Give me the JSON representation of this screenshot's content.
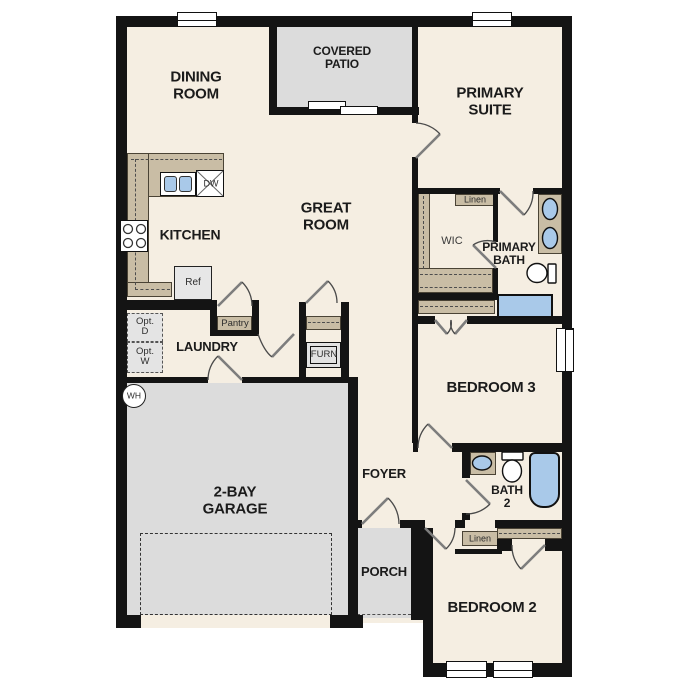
{
  "title": "Single-story floor plan",
  "colors": {
    "interior_floor": "#f5eee2",
    "outdoor_concrete": "#dcdcdc",
    "cabinet_tan": "#c9bda5",
    "fixture_blue": "#a9c9e9",
    "wall_black": "#141414"
  },
  "labels": {
    "dining_room": "DINING\nROOM",
    "covered_patio": "COVERED\nPATIO",
    "primary_suite": "PRIMARY\nSUITE",
    "kitchen": "KITCHEN",
    "great_room": "GREAT\nROOM",
    "wic": "WIC",
    "primary_bath": "PRIMARY\nBATH",
    "linen_upper": "Linen",
    "linen_lower": "Linen",
    "pantry": "Pantry",
    "laundry": "LAUNDRY",
    "furnace": "FURN",
    "opt_dryer": "Opt.\nD",
    "opt_washer": "Opt.\nW",
    "water_heater": "WH",
    "bedroom_3": "BEDROOM 3",
    "garage": "2-BAY\nGARAGE",
    "foyer": "FOYER",
    "bath_2": "BATH\n2",
    "porch": "PORCH",
    "bedroom_2": "BEDROOM 2",
    "refrigerator": "Ref",
    "dishwasher": "DW"
  }
}
